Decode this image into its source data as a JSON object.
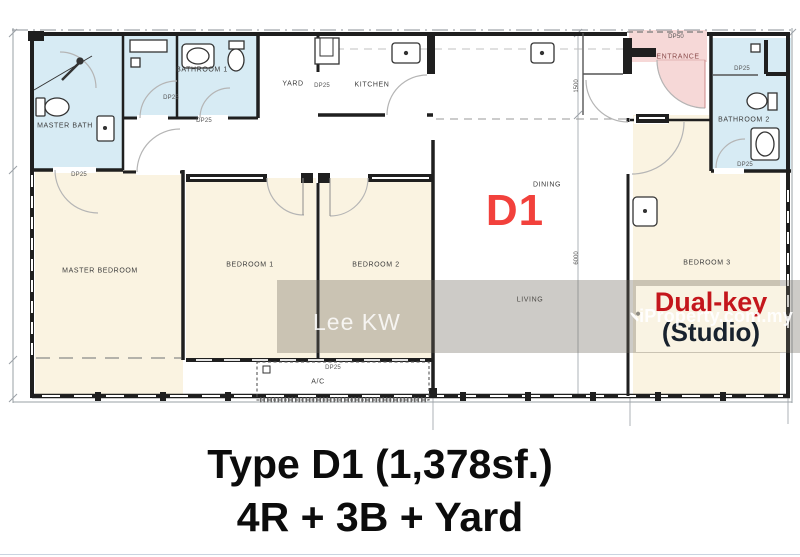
{
  "page": {
    "type": "apartment floor plan listing image"
  },
  "plan": {
    "unit_code": "D1",
    "rooms": {
      "master_bath": {
        "label": "MASTER BATH"
      },
      "bathroom_1": {
        "label": "BATHROOM 1"
      },
      "yard": {
        "label": "YARD"
      },
      "kitchen": {
        "label": "KITCHEN"
      },
      "entrance": {
        "label": "ENTRANCE"
      },
      "bathroom_2": {
        "label": "BATHROOM 2"
      },
      "master_bedroom": {
        "label": "MASTER BEDROOM"
      },
      "bedroom_1": {
        "label": "BEDROOM 1"
      },
      "bedroom_2": {
        "label": "BEDROOM 2"
      },
      "bedroom_3": {
        "label": "BEDROOM 3"
      },
      "dining": {
        "label": "DINING"
      },
      "living": {
        "label": "LIVING"
      },
      "ac_ledge": {
        "label": "A/C"
      }
    },
    "dimensions": {
      "dp50": "DP50",
      "dp25": "DP25",
      "entry_depth": "1500",
      "living_depth": "6000"
    },
    "dual_key": {
      "title": "Dual-key",
      "subtitle": "(Studio)"
    },
    "colors": {
      "unit_red": "#f2413c",
      "dual_key_red": "#c4161c",
      "bath_blue": "#d7ebf4",
      "bedroom_cream": "#faf3e1",
      "entrance_pink": "#f6d8d7",
      "dual_key_box": "#f9f3e3"
    }
  },
  "watermarks": {
    "agent": "Lee KW",
    "brand": "iProperty.com.my"
  },
  "caption": {
    "line1": "Type D1 (1,378sf.)",
    "line2": "4R + 3B + Yard"
  }
}
